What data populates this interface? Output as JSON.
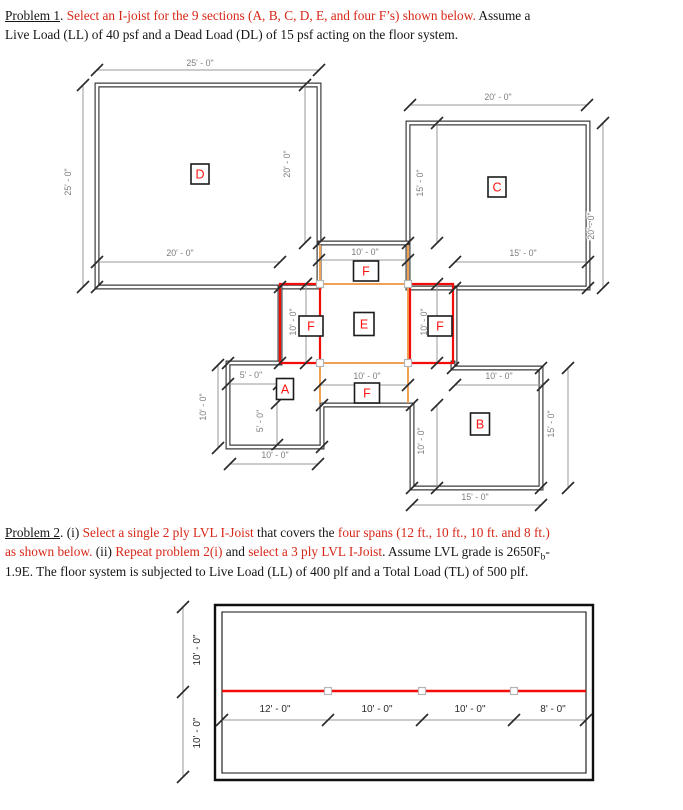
{
  "problem1": {
    "lines": [
      [
        {
          "t": "Problem 1",
          "u": true
        },
        {
          "t": ". "
        },
        {
          "t": "Select an I-joist for the 9 sections (A, B, C, D, E, and four F’s) shown below.",
          "red": true
        },
        {
          "t": " Assume a"
        }
      ],
      [
        {
          "t": "Live Load (LL) of 40 psf and a Dead Load (DL) of 15 psf acting on the floor system."
        }
      ]
    ]
  },
  "problem2": {
    "lines": [
      [
        {
          "t": "Problem 2",
          "u": true
        },
        {
          "t": ". (i) "
        },
        {
          "t": "Select a single 2 ply LVL I-Joist",
          "red": true
        },
        {
          "t": " that covers the "
        },
        {
          "t": "four spans (12 ft., 10 ft., 10 ft. and 8 ft.)",
          "red": true
        }
      ],
      [
        {
          "t": "as shown below.",
          "red": true
        },
        {
          "t": " (ii) "
        },
        {
          "t": "Repeat problem 2(i)",
          "red": true
        },
        {
          "t": " and "
        },
        {
          "t": "select a 3 ply LVL I-Joist",
          "red": true
        },
        {
          "t": ". Assume LVL grade is 2650F"
        },
        {
          "t": "b",
          "sub": true
        },
        {
          "t": "-"
        }
      ],
      [
        {
          "t": "1.9E. The floor system is subjected to Live Load (LL) of 400 plf and a Total Load (TL) of 500 plf."
        }
      ]
    ]
  },
  "colors": {
    "wall_top": "#3c3c3c",
    "wall_bottom": "#101010",
    "dim_line": "#9a9a9a",
    "tick": "#2a2a2a",
    "dim_text_top": "#7c7c7c",
    "dim_text_bottom": "#2b2b2b",
    "beam_orange": "#efa156",
    "beam_red": "#f20d0a",
    "label_red": "#fb1310",
    "body_red": "#d62718"
  },
  "drawings": [
    {
      "name": "problem1-floor-plan",
      "wall_color": "#3c3c3c",
      "wall_w": 5,
      "walls": [
        {
          "d": "M97,85 H319 V287 H97 Z"
        },
        {
          "d": "M408,123 H588 V288 H408 Z"
        },
        {
          "d": "M319,243 H408"
        },
        {
          "d": "M280,287 V363"
        },
        {
          "d": "M455,288 V368"
        },
        {
          "d": "M280,363 H228 V447 H322 V405 H412 V488 H541 V368 H453 V363"
        }
      ],
      "lines": [
        {
          "d": "M320,245 V403",
          "c": "#efa156",
          "w": 2,
          "n": "beam-line-orange-left"
        },
        {
          "d": "M408,245 V403",
          "c": "#efa156",
          "w": 2,
          "n": "beam-line-orange-right"
        },
        {
          "d": "M320,284 H408",
          "c": "#efa156",
          "w": 2,
          "n": "beam-line-orange-top"
        },
        {
          "d": "M320,363 H408",
          "c": "#efa156",
          "w": 2,
          "n": "beam-line-orange-bottom"
        },
        {
          "d": "M280,284 H320 V363 H280 Z",
          "c": "#f20d0a",
          "w": 2.2,
          "n": "beam-box-red-left"
        },
        {
          "d": "M410,284 H453 V363 H410 Z",
          "c": "#f20d0a",
          "w": 2.2,
          "n": "beam-box-red-right"
        }
      ],
      "squares": [
        {
          "x": 320,
          "y": 284
        },
        {
          "x": 408,
          "y": 284
        },
        {
          "x": 320,
          "y": 363
        },
        {
          "x": 408,
          "y": 363
        }
      ],
      "dims": [
        {
          "x1": 97,
          "y1": 70,
          "x2": 319,
          "y2": 70
        },
        {
          "x1": 83,
          "y1": 85,
          "x2": 83,
          "y2": 287
        },
        {
          "x1": 305,
          "y1": 85,
          "x2": 305,
          "y2": 243
        },
        {
          "x1": 97,
          "y1": 262,
          "x2": 280,
          "y2": 262
        },
        {
          "x1": 319,
          "y1": 260,
          "x2": 408,
          "y2": 260
        },
        {
          "x1": 455,
          "y1": 262,
          "x2": 588,
          "y2": 262
        },
        {
          "x1": 410,
          "y1": 105,
          "x2": 587,
          "y2": 105
        },
        {
          "x1": 437,
          "y1": 123,
          "x2": 437,
          "y2": 243
        },
        {
          "x1": 603,
          "y1": 123,
          "x2": 603,
          "y2": 288
        },
        {
          "x1": 306,
          "y1": 284,
          "x2": 306,
          "y2": 363
        },
        {
          "x1": 437,
          "y1": 284,
          "x2": 437,
          "y2": 363
        },
        {
          "x1": 320,
          "y1": 385,
          "x2": 408,
          "y2": 385
        },
        {
          "x1": 228,
          "y1": 384,
          "x2": 279,
          "y2": 384
        },
        {
          "x1": 218,
          "y1": 365,
          "x2": 218,
          "y2": 448
        },
        {
          "x1": 277,
          "y1": 403,
          "x2": 277,
          "y2": 445
        },
        {
          "x1": 230,
          "y1": 464,
          "x2": 318,
          "y2": 464
        },
        {
          "x1": 455,
          "y1": 385,
          "x2": 543,
          "y2": 385
        },
        {
          "x1": 568,
          "y1": 368,
          "x2": 568,
          "y2": 488
        },
        {
          "x1": 437,
          "y1": 405,
          "x2": 437,
          "y2": 488
        },
        {
          "x1": 412,
          "y1": 505,
          "x2": 541,
          "y2": 505
        }
      ],
      "ticks": [
        {
          "x": 319,
          "y": 243
        },
        {
          "x": 408,
          "y": 243
        },
        {
          "x": 97,
          "y": 287
        },
        {
          "x": 280,
          "y": 287
        },
        {
          "x": 228,
          "y": 363
        },
        {
          "x": 280,
          "y": 363
        },
        {
          "x": 322,
          "y": 405
        },
        {
          "x": 412,
          "y": 405
        },
        {
          "x": 322,
          "y": 447
        },
        {
          "x": 453,
          "y": 368
        },
        {
          "x": 541,
          "y": 368
        },
        {
          "x": 588,
          "y": 288
        },
        {
          "x": 455,
          "y": 288
        },
        {
          "x": 541,
          "y": 488
        },
        {
          "x": 412,
          "y": 488
        }
      ],
      "dim_text": "#7c7c7c",
      "dim_size": 8.8,
      "dimlabels": [
        {
          "t": "25' - 0\"",
          "x": 200,
          "y": 66
        },
        {
          "t": "25' - 0\"",
          "x": 71,
          "y": 182,
          "r": -90
        },
        {
          "t": "20' - 0\"",
          "x": 290,
          "y": 164,
          "r": -90
        },
        {
          "t": "20' - 0\"",
          "x": 180,
          "y": 256
        },
        {
          "t": "10' - 0\"",
          "x": 365,
          "y": 255
        },
        {
          "t": "15' - 0\"",
          "x": 523,
          "y": 256
        },
        {
          "t": "20' - 0\"",
          "x": 498,
          "y": 100
        },
        {
          "t": "15' - 0\"",
          "x": 423,
          "y": 183,
          "r": -90
        },
        {
          "t": "20' - 0\"",
          "x": 594,
          "y": 226,
          "r": -90
        },
        {
          "t": "10' - 0\"",
          "x": 296,
          "y": 322,
          "r": -90
        },
        {
          "t": "10' - 0\"",
          "x": 427,
          "y": 322,
          "r": -90
        },
        {
          "t": "10' - 0\"",
          "x": 367,
          "y": 379
        },
        {
          "t": "5' - 0\"",
          "x": 251,
          "y": 378
        },
        {
          "t": "10' - 0\"",
          "x": 206,
          "y": 407,
          "r": -90
        },
        {
          "t": "5' - 0\"",
          "x": 263,
          "y": 421,
          "r": -90
        },
        {
          "t": "10' - 0\"",
          "x": 275,
          "y": 458
        },
        {
          "t": "10' - 0\"",
          "x": 499,
          "y": 379
        },
        {
          "t": "15' - 0\"",
          "x": 554,
          "y": 424,
          "r": -90
        },
        {
          "t": "10' - 0\"",
          "x": 424,
          "y": 441,
          "r": -90
        },
        {
          "t": "15' - 0\"",
          "x": 475,
          "y": 500
        }
      ],
      "roomlabels": [
        {
          "t": "D",
          "x": 200,
          "y": 174,
          "w": 18,
          "h": 20
        },
        {
          "t": "C",
          "x": 497,
          "y": 187,
          "w": 18,
          "h": 20
        },
        {
          "t": "E",
          "x": 364,
          "y": 324,
          "w": 20,
          "h": 23
        },
        {
          "t": "A",
          "x": 285,
          "y": 389,
          "w": 17,
          "h": 21
        },
        {
          "t": "B",
          "x": 480,
          "y": 424,
          "w": 19,
          "h": 22
        },
        {
          "t": "F",
          "x": 366,
          "y": 271,
          "w": 25,
          "h": 20
        },
        {
          "t": "F",
          "x": 311,
          "y": 326,
          "w": 24,
          "h": 20
        },
        {
          "t": "F",
          "x": 440,
          "y": 326,
          "w": 24,
          "h": 20
        },
        {
          "t": "F",
          "x": 367,
          "y": 393,
          "w": 25,
          "h": 20
        }
      ]
    },
    {
      "name": "problem2-beam-plan",
      "wall_color": "#101010",
      "wall_w": 0,
      "walls": [],
      "lines": [
        {
          "d": "M215,605 H593 V780 H215 Z",
          "c": "#101010",
          "w": 2.4,
          "n": "outer-wall"
        },
        {
          "d": "M222,612 H586 V773 H222 Z",
          "c": "#101010",
          "w": 1.1,
          "n": "inner-wall"
        },
        {
          "d": "M222,691 H586",
          "c": "#f20d0a",
          "w": 2.6,
          "n": "beam-line-red"
        }
      ],
      "squares": [
        {
          "x": 328,
          "y": 691
        },
        {
          "x": 422,
          "y": 691
        },
        {
          "x": 514,
          "y": 691
        }
      ],
      "dims": [
        {
          "x1": 222,
          "y1": 720,
          "x2": 586,
          "y2": 720
        },
        {
          "x1": 183,
          "y1": 607,
          "x2": 183,
          "y2": 777
        }
      ],
      "ticks": [
        {
          "x": 328,
          "y": 720
        },
        {
          "x": 422,
          "y": 720
        },
        {
          "x": 514,
          "y": 720
        },
        {
          "x": 183,
          "y": 692
        }
      ],
      "dim_text": "#2b2b2b",
      "dim_size": 10,
      "dimlabels": [
        {
          "t": "12' - 0\"",
          "x": 275,
          "y": 712
        },
        {
          "t": "10' - 0\"",
          "x": 377,
          "y": 712
        },
        {
          "t": "10' - 0\"",
          "x": 470,
          "y": 712
        },
        {
          "t": "8' - 0\"",
          "x": 553,
          "y": 712
        },
        {
          "t": "10' - 0\"",
          "x": 200,
          "y": 650,
          "r": -90
        },
        {
          "t": "10' - 0\"",
          "x": 200,
          "y": 733,
          "r": -90
        }
      ],
      "roomlabels": []
    }
  ]
}
